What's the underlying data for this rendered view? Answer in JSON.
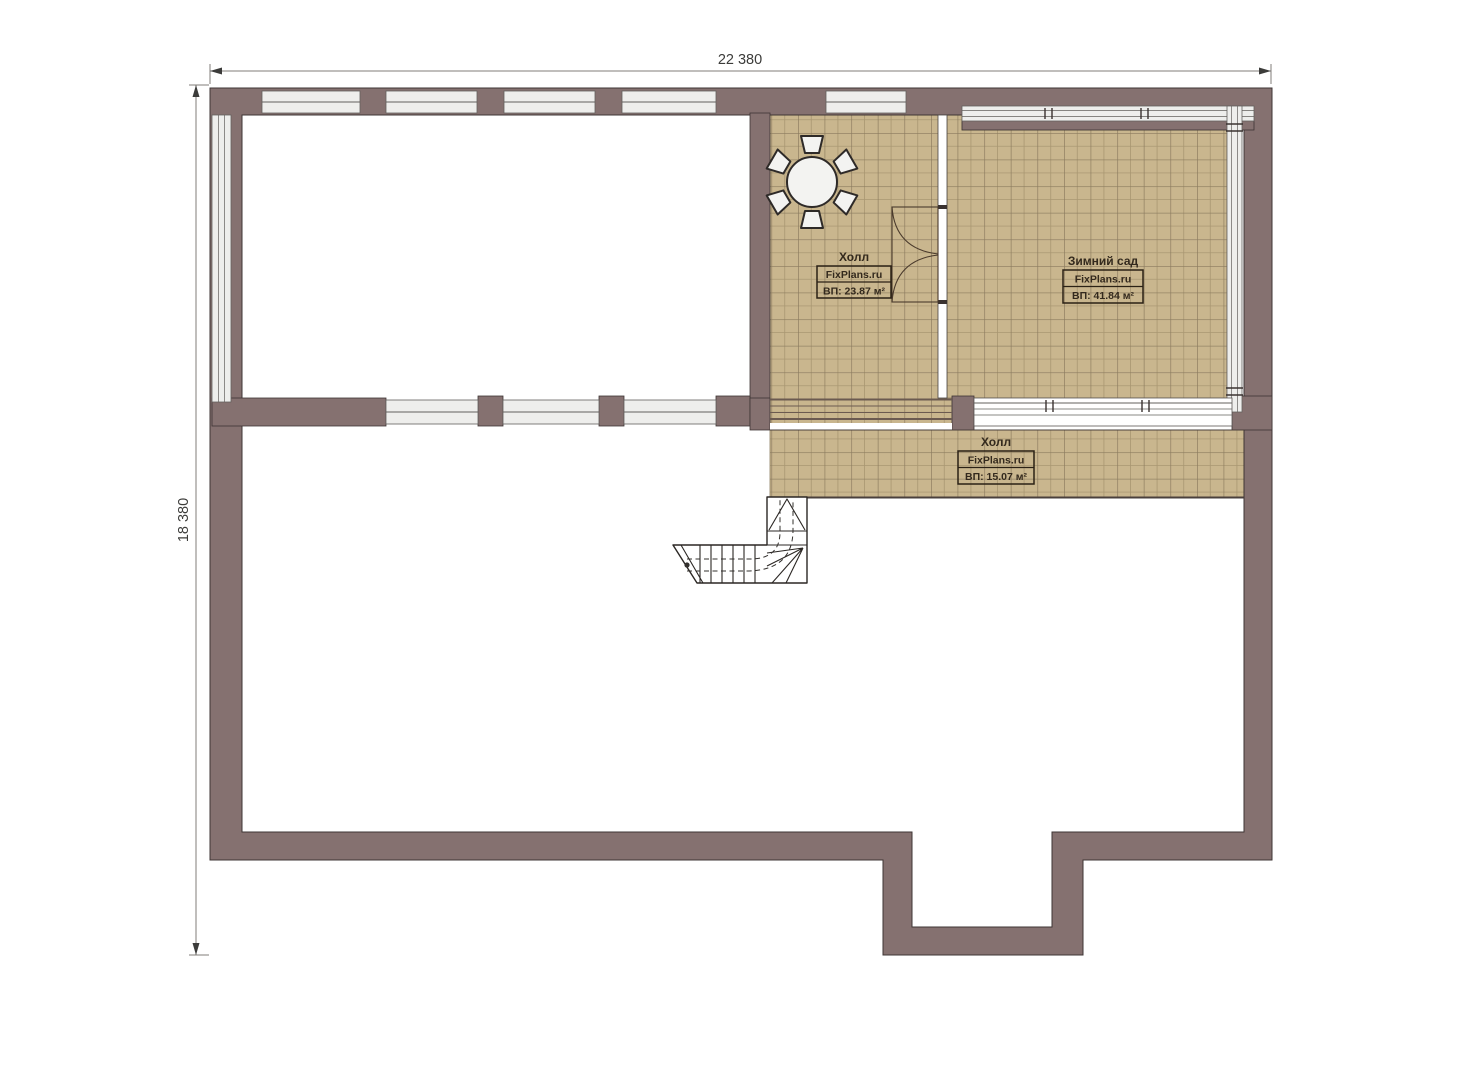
{
  "plan": {
    "dimension_width": "22 380",
    "dimension_height": "18 380",
    "rooms": {
      "hall_upper": {
        "name": "Холл",
        "brand": "FixPlans.ru",
        "area": "ВП: 23.87 м²"
      },
      "winter_garden": {
        "name": "Зимний сад",
        "brand": "FixPlans.ru",
        "area": "ВП: 41.84 м²"
      },
      "hall_lower": {
        "name": "Холл",
        "brand": "FixPlans.ru",
        "area": "ВП: 15.07 м²"
      }
    }
  },
  "colors": {
    "paper": "#ffffff",
    "wall": "#857170",
    "wall-outline": "#3e3534",
    "tile": "#c9b68e",
    "tile-line-minor": "#a99772",
    "tile-line-major": "#8a7a5e",
    "glass": "#eeeeec",
    "glass-line": "#63605e",
    "drawing-line": "#2e2a28",
    "label-text": "#33291d",
    "dimension-line": "#807d7a",
    "dimension-text": "#3c3c3a"
  }
}
